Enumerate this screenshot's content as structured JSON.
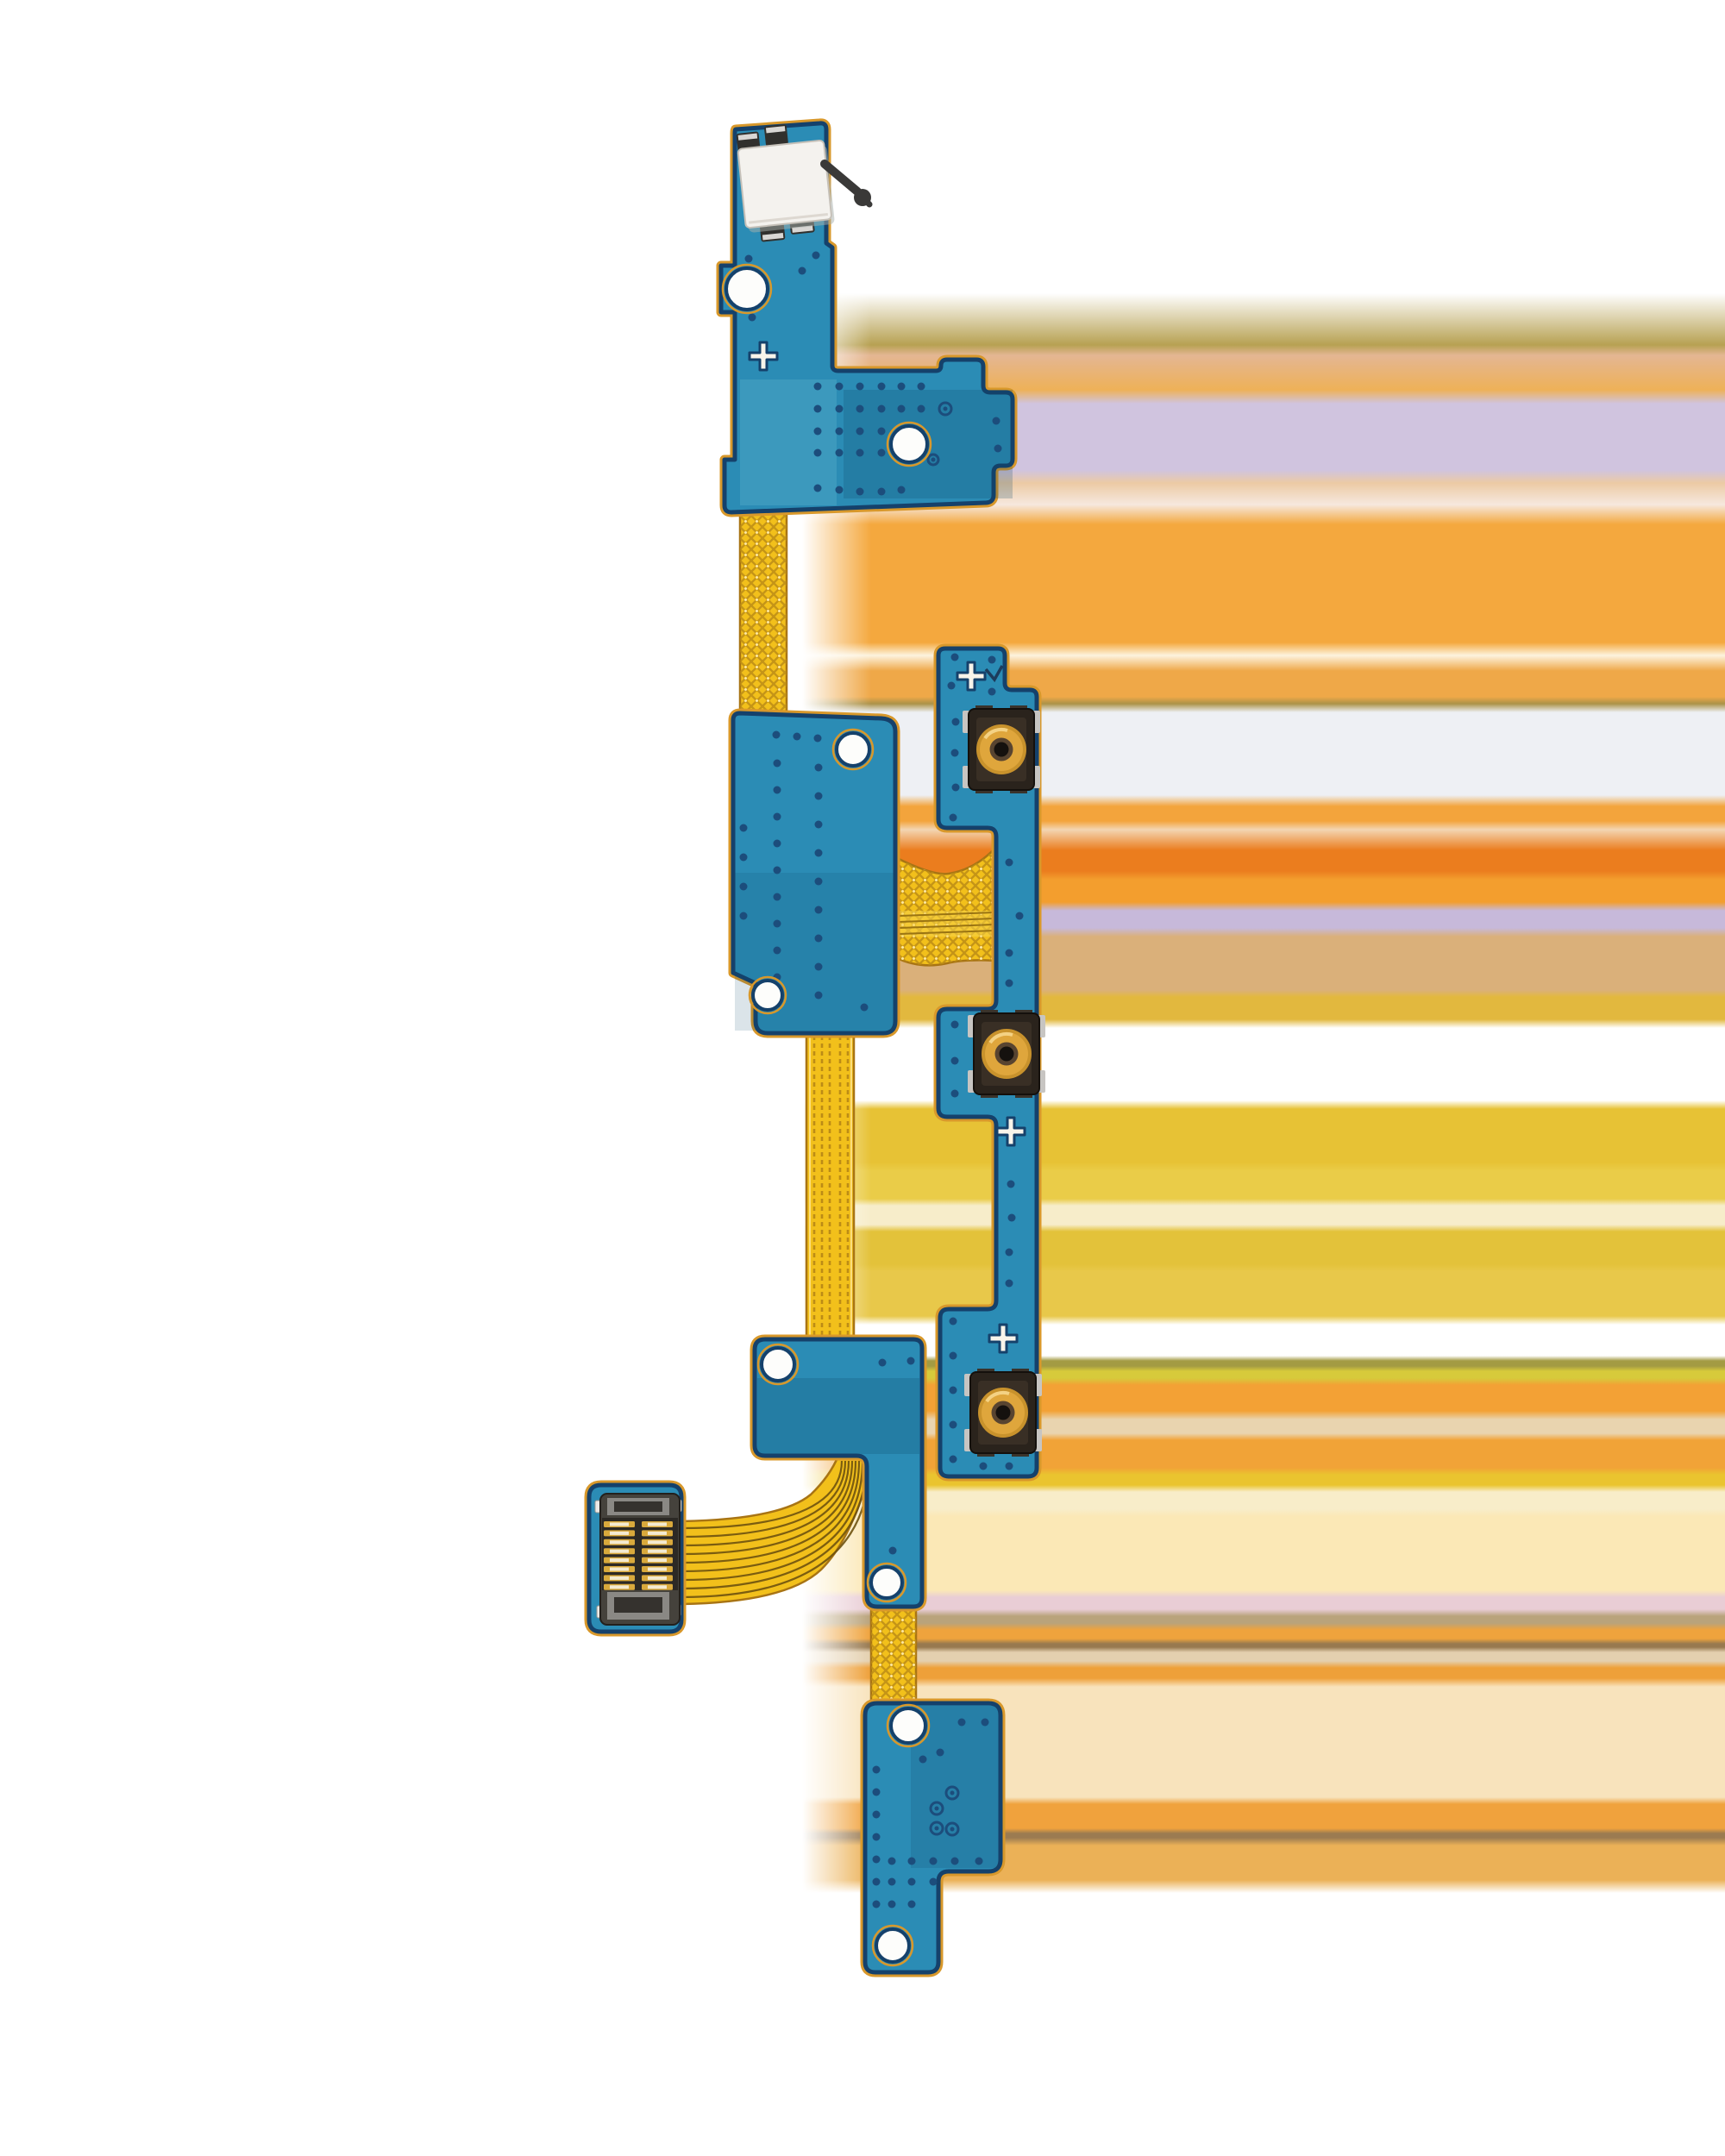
{
  "meta": {
    "subject": "power-volume-button-flex-cable",
    "view": "product-photo-on-white-background",
    "orientation": "vertical"
  },
  "colors": {
    "background_white": "#ffffff",
    "board_teal": "#2b8cb5",
    "board_shade": "#0e4a6b",
    "board_outline_navy": "#15416b",
    "board_edge_gold": "#d8982b",
    "solder_mask_light": "#6fc0d8",
    "via_dot": "#1c4d7c",
    "hole_white": "#fdfdfb",
    "flex_yellow": "#f2c01b",
    "flex_mesh": "#bc8c16",
    "flex_edge": "#a87414",
    "flex_highlight": "#ffe9a0",
    "trace_dark": "#6e5210",
    "button_body_dark": "#2a231c",
    "button_gold": "#dfa63c",
    "button_gold_deep": "#c8922c",
    "button_ring": "#584430",
    "button_center_dark": "#15110e",
    "metal_clip": "#c7c5c2",
    "mic_white": "#f4f2ee",
    "mic_shadow": "#a8b0ac",
    "clip_dark": "#31302d",
    "clip_light": "#d9d7d4",
    "lever_black": "#3a3938",
    "connector_body": "#45423c",
    "connector_dark": "#2c2925",
    "connector_bracket": "#8a8884",
    "connector_pin_gold": "#d9a93c",
    "connector_pin_core": "#f3ead2",
    "connector_pad": "#eceae6"
  },
  "parts": {
    "top_board": {
      "name": "microphone-sensor-board",
      "holes": 2,
      "fiducial_crosses": 1,
      "has_microphone": true,
      "has_black_lever": true,
      "via_rings": 2
    },
    "middle_board": {
      "name": "mid-shield-board",
      "holes": 2
    },
    "button_strip": {
      "name": "side-key-strip",
      "tactile_switches": 3,
      "fiducial_crosses": 3
    },
    "lower_board": {
      "name": "lower-shield-board",
      "holes": 2
    },
    "connector_board": {
      "name": "board-to-board-connector-board",
      "pin_rows": 8,
      "pin_columns": 2,
      "corner_pads": 4
    },
    "bottom_board": {
      "name": "bottom-terminal-board",
      "holes": 2,
      "ringed_vias": 4
    },
    "ribbons": {
      "count": 3,
      "pattern": "gold-crosshatch-mesh"
    },
    "bridge_flex": {
      "name": "h-bridge-flex",
      "trace_lines": 4
    },
    "curved_flex": {
      "name": "connector-curved-flex",
      "trace_lines": 9
    }
  },
  "background": {
    "base": "#ffffff",
    "artifact_bands": [
      [
        340,
        "#ffffff"
      ],
      [
        400,
        "#b7a152"
      ],
      [
        412,
        "#e4b693"
      ],
      [
        452,
        "#eeb158"
      ],
      [
        468,
        "#d0c4df"
      ],
      [
        545,
        "#d0c4df"
      ],
      [
        560,
        "#eccaa4"
      ],
      [
        585,
        "#f6e8de"
      ],
      [
        608,
        "#f4a83e"
      ],
      [
        745,
        "#f4a83e"
      ],
      [
        760,
        "#fdf3de"
      ],
      [
        778,
        "#efa848"
      ],
      [
        808,
        "#efa848"
      ],
      [
        816,
        "#ac9248"
      ],
      [
        826,
        "#eef0f4"
      ],
      [
        922,
        "#eef0f4"
      ],
      [
        935,
        "#f3a43c"
      ],
      [
        952,
        "#f3a43c"
      ],
      [
        962,
        "#f3d5b2"
      ],
      [
        986,
        "#eb7d1e"
      ],
      [
        1010,
        "#eb7d1e"
      ],
      [
        1020,
        "#f39e2e"
      ],
      [
        1046,
        "#f39e2e"
      ],
      [
        1056,
        "#c7b9da"
      ],
      [
        1076,
        "#c7b9da"
      ],
      [
        1086,
        "#dab07a"
      ],
      [
        1148,
        "#dab07a"
      ],
      [
        1156,
        "#e2b83e"
      ],
      [
        1182,
        "#e2b83e"
      ],
      [
        1192,
        "#ffffff"
      ],
      [
        1276,
        "#ffffff"
      ],
      [
        1286,
        "#e7c235"
      ],
      [
        1348,
        "#e7c235"
      ],
      [
        1358,
        "#eacc48"
      ],
      [
        1390,
        "#eacc48"
      ],
      [
        1398,
        "#f7edca"
      ],
      [
        1420,
        "#f7edca"
      ],
      [
        1428,
        "#e3c23a"
      ],
      [
        1466,
        "#e3c23a"
      ],
      [
        1474,
        "#e8c84a"
      ],
      [
        1526,
        "#e8c84a"
      ],
      [
        1536,
        "#ffffff"
      ],
      [
        1572,
        "#ffffff"
      ],
      [
        1578,
        "#a39b43"
      ],
      [
        1584,
        "#a39b43"
      ],
      [
        1590,
        "#d7ca3b"
      ],
      [
        1598,
        "#d7ca3b"
      ],
      [
        1606,
        "#f3a135"
      ],
      [
        1636,
        "#f3a135"
      ],
      [
        1646,
        "#e9d4af"
      ],
      [
        1662,
        "#e9d4af"
      ],
      [
        1670,
        "#f1a337"
      ],
      [
        1702,
        "#f1a337"
      ],
      [
        1710,
        "#eac42f"
      ],
      [
        1722,
        "#eac42f"
      ],
      [
        1730,
        "#f8edc9"
      ],
      [
        1750,
        "#f8edc9"
      ],
      [
        1758,
        "#fbe8b6"
      ],
      [
        1844,
        "#fbe8b6"
      ],
      [
        1852,
        "#e9cdd5"
      ],
      [
        1866,
        "#e9cdd5"
      ],
      [
        1874,
        "#b9a37b"
      ],
      [
        1882,
        "#b9a37b"
      ],
      [
        1890,
        "#efa33d"
      ],
      [
        1900,
        "#efa33d"
      ],
      [
        1906,
        "#98794f"
      ],
      [
        1910,
        "#98794f"
      ],
      [
        1916,
        "#e4d0af"
      ],
      [
        1926,
        "#e4d0af"
      ],
      [
        1934,
        "#eea039"
      ],
      [
        1946,
        "#eea039"
      ],
      [
        1956,
        "#f8e3bc"
      ],
      [
        2084,
        "#f8e3bc"
      ],
      [
        2092,
        "#f0a23d"
      ],
      [
        2120,
        "#f0a23d"
      ],
      [
        2126,
        "#9b7b51"
      ],
      [
        2131,
        "#9b7b51"
      ],
      [
        2140,
        "#ebb157"
      ],
      [
        2180,
        "#ebb157"
      ],
      [
        2195,
        "#ffffff"
      ],
      [
        2500,
        "#ffffff"
      ]
    ]
  }
}
